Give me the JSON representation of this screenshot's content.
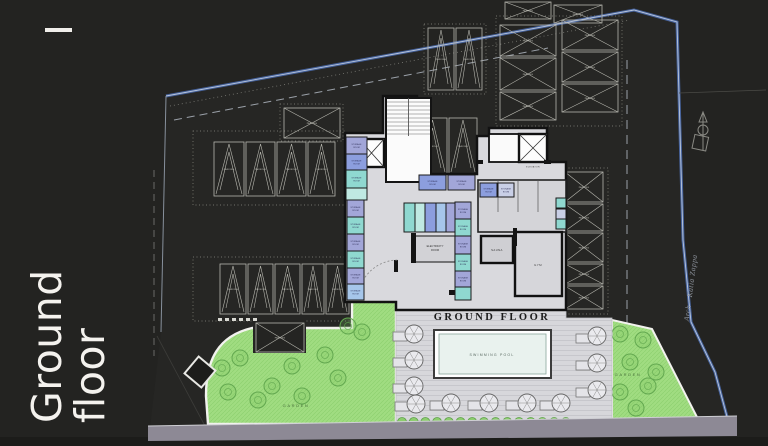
{
  "sidebar": {
    "line1": "Ground",
    "line2": "floor"
  },
  "plan": {
    "title": "GROUND FLOOR",
    "pool_label": "SWIMMING POOL",
    "garden_left_label": "GARDEN",
    "garden_right_label": "GARDEN",
    "street_label": "Arch - Katia Zappa",
    "rooms": {
      "parking": "PARKING",
      "storage_line1": "STORAGE",
      "storage_line2": "ROOM",
      "electricity_line1": "ELECTRICITY",
      "electricity_line2": "ROOM",
      "sauna": "SAUNA",
      "gym": "GYM",
      "elevator": "ELEVATOR"
    },
    "colors": {
      "boundary_blue": "#47639c",
      "garden_green": "#a0dc81",
      "room_lavender": "#a2a6d8",
      "room_periwinkle": "#8c9ede",
      "room_teal": "#8fd8d0",
      "room_mint": "#bfe9e2",
      "room_blue": "#a6c6ea",
      "room_pale": "#c9cfe6",
      "deck_gray": "#d7d7db",
      "road_gray": "#8d8995"
    }
  }
}
